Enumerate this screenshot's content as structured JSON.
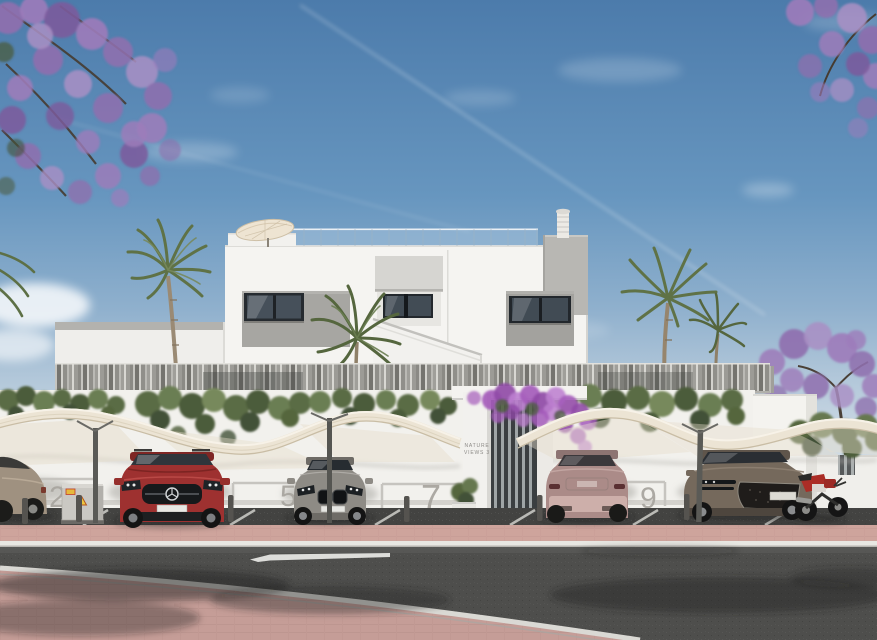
{
  "scene": {
    "entrance_sign": {
      "line1": "NATURE",
      "line2": "VIEWS 3"
    },
    "parking_bay_numbers": {
      "bay_a": "2",
      "bay_b": "5",
      "bay_c": "7",
      "bay_d": "9"
    },
    "palette": {
      "sky_top": "#4c7bab",
      "sky_horizon": "#ccd9e4",
      "building_white": "#f5f4f1",
      "panel_gray": "#a7a6a2",
      "jacaranda_purple": "#9d7cba",
      "bougainvillea_purple": "#a55cbb",
      "canopy_cream": "#ece4d4",
      "suv_red": "#9e3130",
      "sedan_gray": "#8e8b85",
      "suv_pink": "#ab8b88",
      "sedan_bronze": "#75695c",
      "sedan_champagne": "#9f9180",
      "motorcycle_red": "#ab2d26",
      "sidewalk_pink": "#d3a79f",
      "asphalt_road": "#4e4e4c",
      "asphalt_parking": "#434341",
      "foliage_green": "#5a6c45"
    }
  }
}
